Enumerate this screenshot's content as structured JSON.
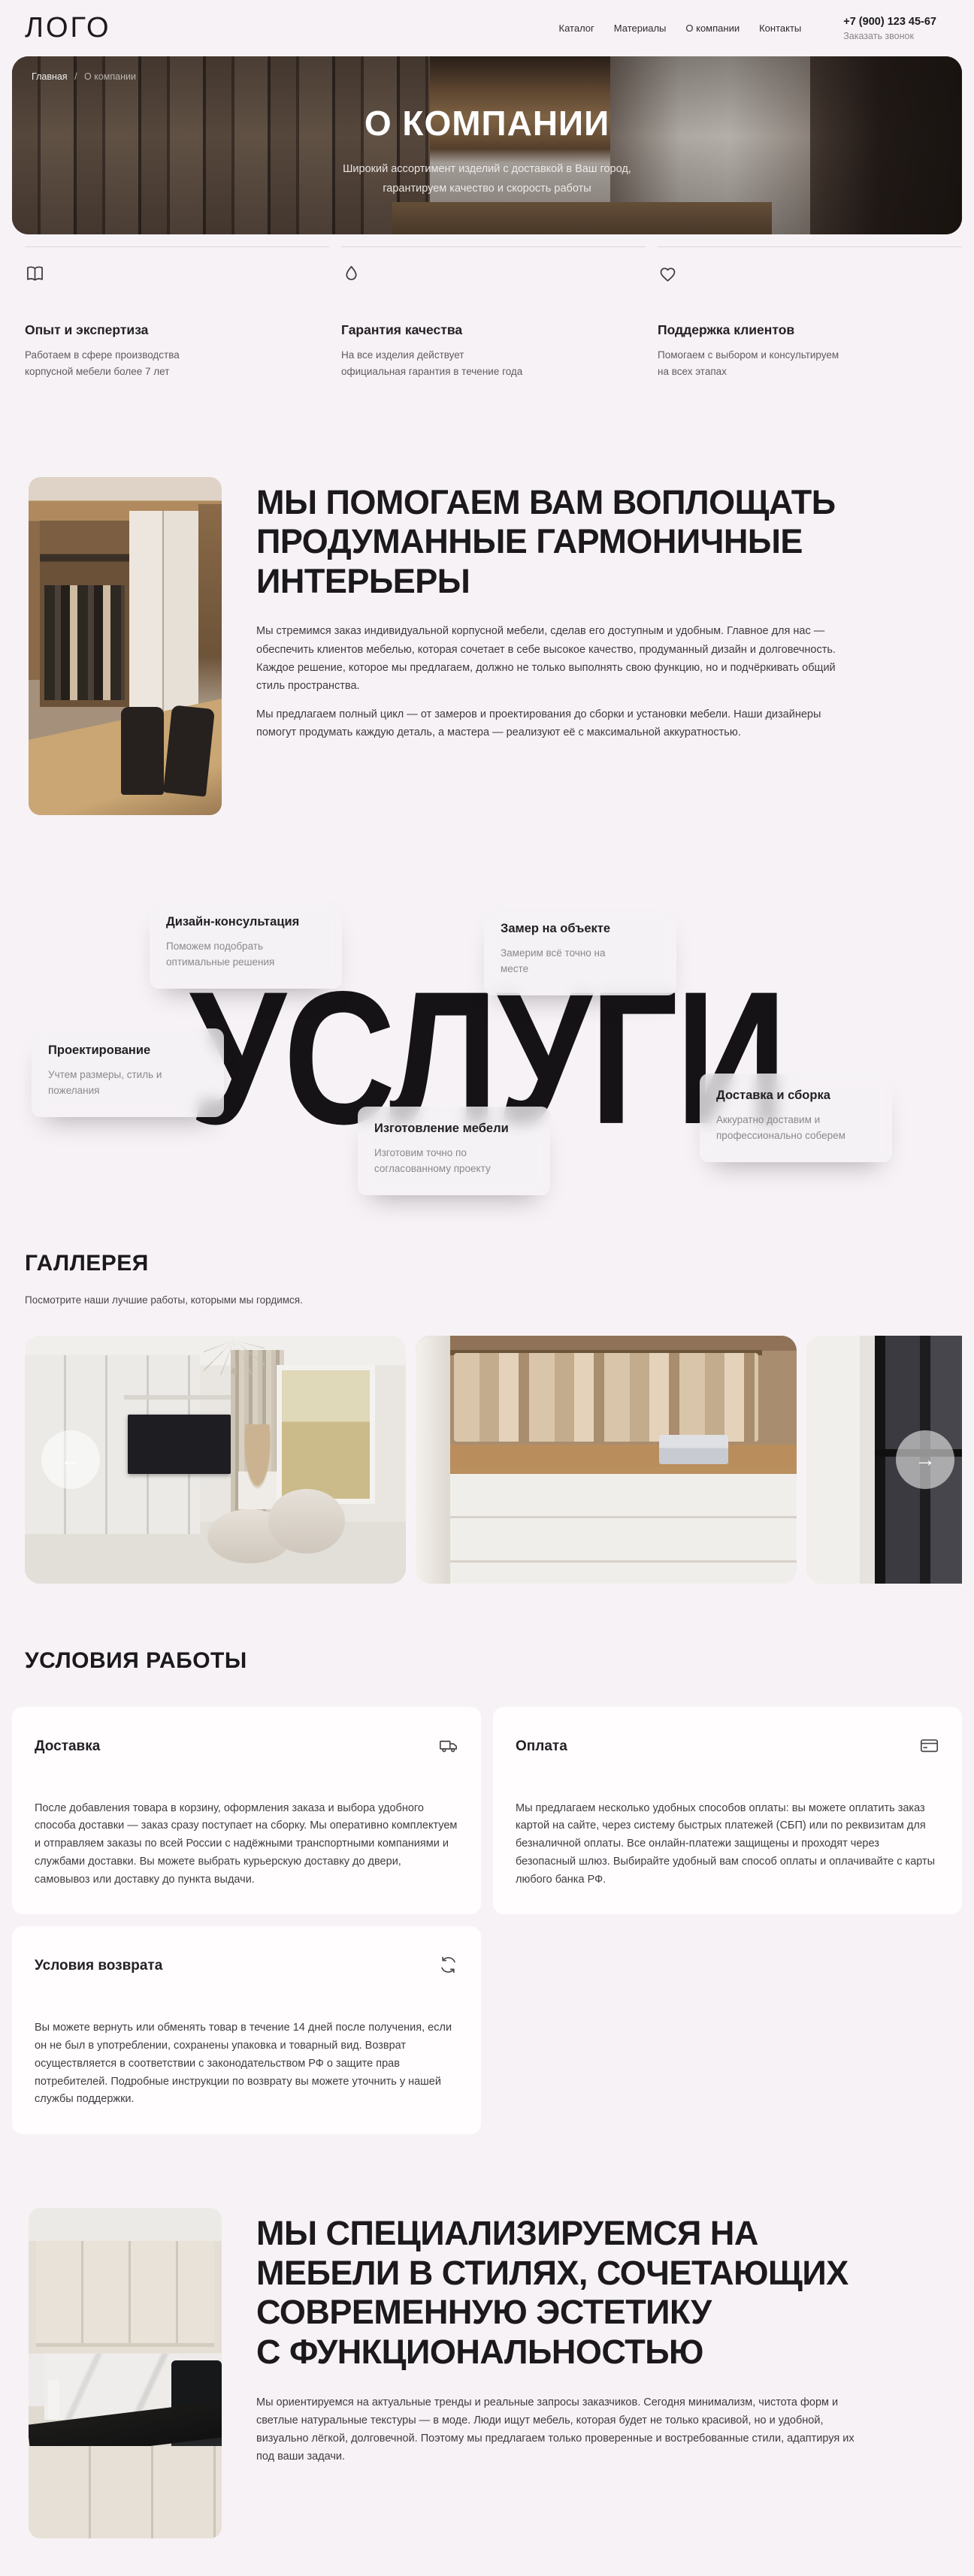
{
  "header": {
    "logo": "ЛОГО",
    "nav": [
      {
        "label": "Каталог"
      },
      {
        "label": "Материалы"
      },
      {
        "label": "О компании"
      },
      {
        "label": "Контакты"
      }
    ],
    "phone": "+7 (900) 123 45-67",
    "callback": "Заказать звонок"
  },
  "hero": {
    "breadcrumb_home": "Главная",
    "breadcrumb_sep": "/",
    "breadcrumb_current": "О компании",
    "title": "О КОМПАНИИ",
    "subtitle_lines": [
      "Широкий ассортимент изделий с доставкой в Ваш город,",
      "гарантируем качество и скорость работы"
    ]
  },
  "features": [
    {
      "icon": "book-icon",
      "title": "Опыт и экспертиза",
      "text": "Работаем в сфере производства корпусной мебели более 7 лет"
    },
    {
      "icon": "shield-icon",
      "title": "Гарантия качества",
      "text": "На все изделия действует официальная гарантия в течение года"
    },
    {
      "icon": "heart-icon",
      "title": "Поддержка клиентов",
      "text": "Помогаем с выбором и консультируем на всех этапах"
    }
  ],
  "about": {
    "heading_lines": [
      "МЫ ПОМОГАЕМ ВАМ ВОПЛОЩАТЬ",
      "ПРОДУМАННЫЕ ГАРМОНИЧНЫЕ",
      "ИНТЕРЬЕРЫ"
    ],
    "paragraphs": [
      "Мы стремимся заказ индивидуальной  корпусной мебели, сделав его доступным и удобным. Главное для нас — обеспечить клиентов мебелью, которая сочетает в себе высокое качество, продуманный дизайн и долговечность. Каждое решение, которое мы предлагаем, должно не только выполнять свою функцию, но и подчёркивать общий стиль пространства.",
      "Мы предлагаем полный цикл — от замеров и проектирования до сборки и установки мебели. Наши дизайнеры помогут продумать каждую деталь, а мастера — реализуют её с максимальной аккуратностью."
    ]
  },
  "services": {
    "watermark": "УСЛУГИ",
    "cards": [
      {
        "title": "Дизайн-консультация",
        "text": "Поможем подобрать оптимальные решения"
      },
      {
        "title": "Замер на объекте",
        "text": "Замерим всё точно на месте"
      },
      {
        "title": "Проектирование",
        "text": "Учтем размеры, стиль и пожелания"
      },
      {
        "title": "Изготовление мебели",
        "text": "Изготовим точно по согласованному проекту"
      },
      {
        "title": "Доставка и сборка",
        "text": "Аккуратно доставим и профессионально соберем"
      }
    ]
  },
  "gallery": {
    "title": "ГАЛЛЕРЕЯ",
    "subtitle": "Посмотрите наши лучшие работы, которыми мы гордимся.",
    "prev_icon": "←",
    "next_icon": "→"
  },
  "conditions": {
    "title": "УСЛОВИЯ РАБОТЫ",
    "cards": [
      {
        "title": "Доставка",
        "icon": "truck-icon",
        "text": "После добавления товара в корзину, оформления заказа и выбора удобного способа доставки — заказ сразу поступает на сборку. Мы оперативно комплектуем и отправляем заказы по всей России с надёжными транспортными компаниями и службами доставки. Вы можете выбрать курьерскую доставку до двери, самовывоз или доставку до пункта выдачи."
      },
      {
        "title": "Оплата",
        "icon": "credit-card-icon",
        "text": "Мы предлагаем несколько удобных способов оплаты: вы можете оплатить заказ картой на сайте, через систему быстрых платежей (СБП) или по реквизитам для безналичной оплаты. Все онлайн-платежи защищены и проходят через безопасный шлюз. Выбирайте удобный вам способ оплаты и оплачивайте с карты любого банка РФ."
      },
      {
        "title": "Условия возврата",
        "icon": "refresh-icon",
        "text": "Вы можете вернуть или обменять товар в течение 14 дней после получения, если он не был в употреблении, сохранены упаковка и товарный вид. Возврат осуществляется в соответствии с законодательством РФ о защите прав потребителей. Подробные инструкции по возврату вы можете уточнить у нашей службы поддержки."
      }
    ]
  },
  "specialization": {
    "heading_lines": [
      "МЫ СПЕЦИАЛИЗИРУЕМСЯ НА",
      "МЕБЕЛИ В СТИЛЯХ, СОЧЕТАЮЩИХ",
      "СОВРЕМЕННУЮ ЭСТЕТИКУ",
      "С ФУНКЦИОНАЛЬНОСТЬЮ"
    ],
    "paragraph": "Мы ориентируемся на актуальные тренды и реальные запросы заказчиков. Сегодня минимализм, чистота форм и светлые натуральные текстуры — в моде. Люди ищут мебель, которая будет не только красивой, но и удобной, визуально лёгкой, долговечной. Поэтому мы предлагаем только проверенные и востребованные стили, адаптируя их под ваши задачи.",
    "colors": {
      "page_bg": "#f7f2f5",
      "card_bg": "#ffffff",
      "text_dark": "#1b191c",
      "text_gray": "#5f5b60"
    }
  }
}
